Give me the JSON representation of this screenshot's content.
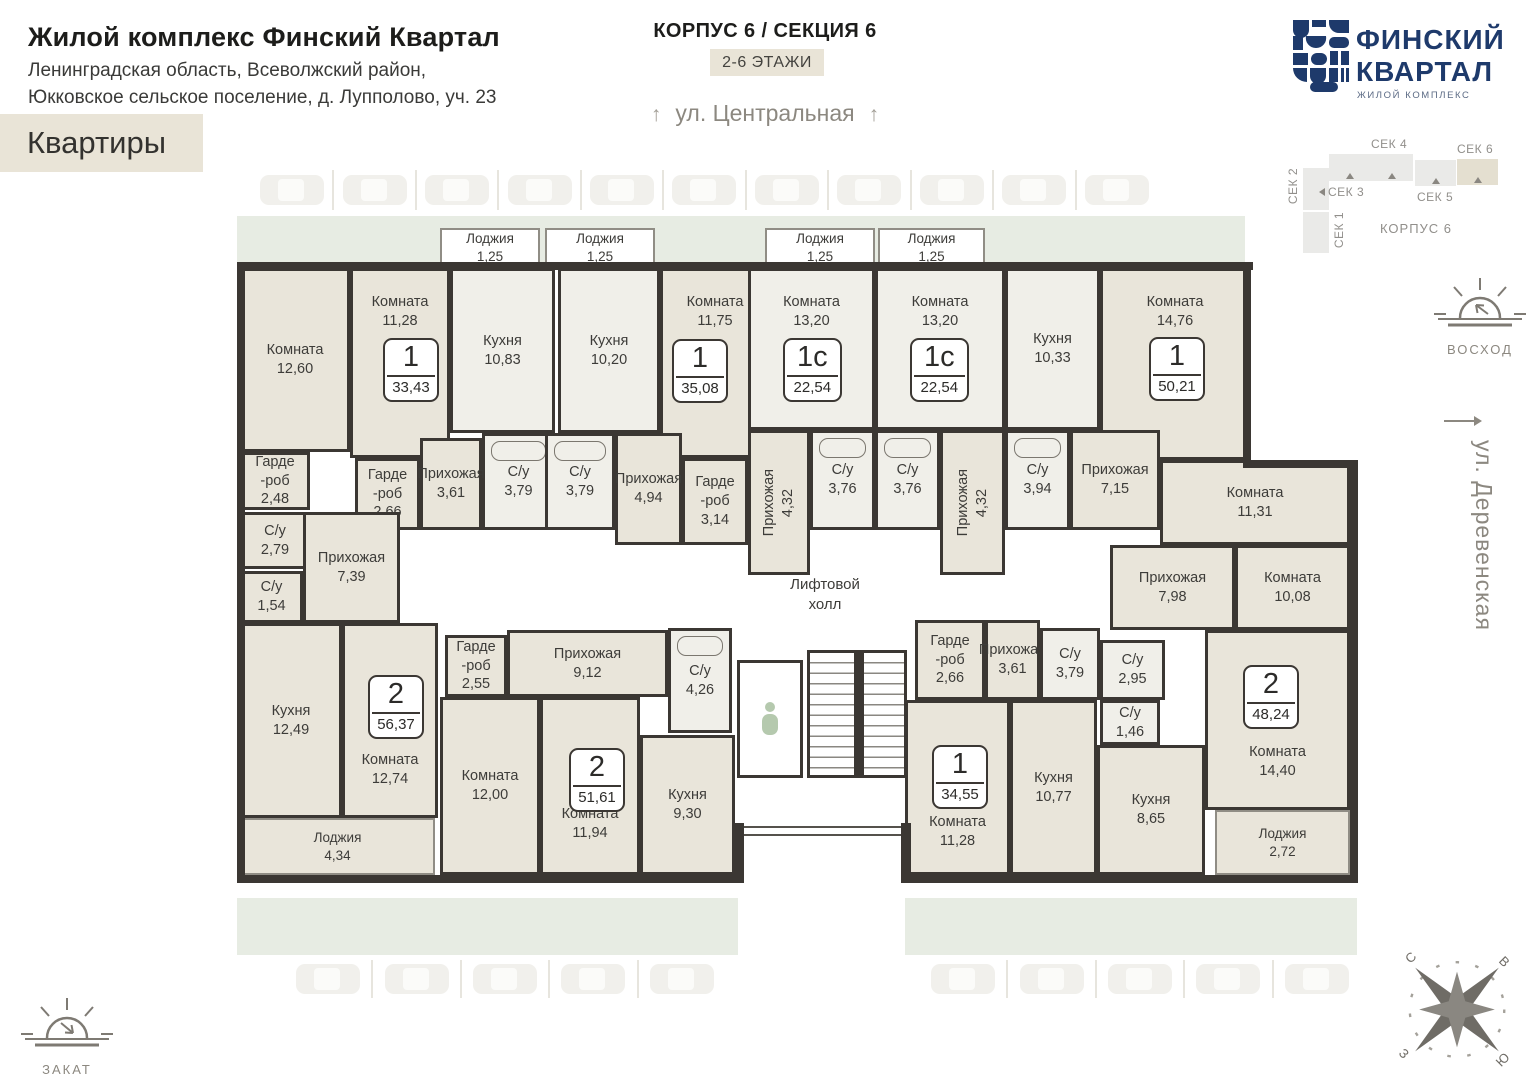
{
  "header": {
    "title": "Жилой комплекс Финский Квартал",
    "address_line1": "Ленинградская область, Всеволжский район,",
    "address_line2": "Юкковское сельское поселение, д. Лупполово, уч. 23",
    "flats_badge": "Квартиры"
  },
  "top_center": {
    "corpus_section": "КОРПУС 6 / СЕКЦИЯ 6",
    "floors_badge": "2-6 ЭТАЖИ",
    "street_top": "ул. Центральная",
    "arrow": "↑"
  },
  "logo": {
    "line1": "ФИНСКИЙ",
    "line2": "КВАРТАЛ",
    "subtitle": "ЖИЛОЙ КОМПЛЕКС",
    "brand_color": "#1e3a6b"
  },
  "minimap": {
    "corpus_label": "КОРПУС 6",
    "blocks": [
      {
        "label": "СЕК 2",
        "x": 18,
        "y": 30,
        "w": 26,
        "h": 42,
        "lpos": "left",
        "marker": "",
        "hl": false
      },
      {
        "label": "СЕК 1",
        "x": 18,
        "y": 74,
        "w": 26,
        "h": 41,
        "lpos": "right",
        "marker": "left",
        "hl": false
      },
      {
        "label": "СЕК 3",
        "x": 44,
        "y": 16,
        "w": 42,
        "h": 27,
        "lpos": "bottom",
        "marker": "up+left",
        "hl": false
      },
      {
        "label": "СЕК 4",
        "x": 86,
        "y": 16,
        "w": 42,
        "h": 27,
        "lpos": "top",
        "marker": "up",
        "hl": false
      },
      {
        "label": "СЕК 5",
        "x": 130,
        "y": 22,
        "w": 41,
        "h": 26,
        "lpos": "bottom",
        "marker": "up",
        "hl": false
      },
      {
        "label": "СЕК 6",
        "x": 172,
        "y": 21,
        "w": 41,
        "h": 26,
        "lpos": "top",
        "marker": "up",
        "hl": true
      }
    ]
  },
  "streets": {
    "right": "ул. Деревенская"
  },
  "sun": {
    "sunrise": "ВОСХОД",
    "sunset": "ЗАКАТ"
  },
  "compass": {
    "n": "С",
    "e": "В",
    "w": "З",
    "s": "Ю"
  },
  "colors": {
    "wall": "#3b3733",
    "cream": "#e9e5da",
    "light": "#f0efe9",
    "green_strip": "#e7ece3",
    "badge_beige": "#e9e4d7",
    "brand_navy": "#1e3a6b"
  },
  "parking": {
    "top_count": 11,
    "bottom_left_count": 5,
    "bottom_right_count": 5
  },
  "plan": {
    "lift_hall": "Лифтовой\nхолл",
    "rooms": [
      {
        "n": "Комната",
        "a": "12,60",
        "x": 3,
        "y": 43,
        "w": 110,
        "h": 184,
        "f": "c"
      },
      {
        "n": "Комната",
        "a": "11,28",
        "x": 113,
        "y": 43,
        "w": 100,
        "h": 190,
        "f": "c",
        "lp": "t"
      },
      {
        "n": "Кухня",
        "a": "10,83",
        "x": 213,
        "y": 43,
        "w": 105,
        "h": 165,
        "f": "l"
      },
      {
        "n": "С/у",
        "a": "3,79",
        "x": 245,
        "y": 208,
        "w": 73,
        "h": 97,
        "f": "l",
        "bath": 1
      },
      {
        "n": "Гарде\n-роб",
        "a": "2,66",
        "x": 118,
        "y": 233,
        "w": 65,
        "h": 72,
        "f": "c"
      },
      {
        "n": "Прихожая",
        "a": "3,61",
        "x": 183,
        "y": 213,
        "w": 62,
        "h": 92,
        "f": "c"
      },
      {
        "n": "Гарде\n-роб",
        "a": "2,48",
        "x": 3,
        "y": 227,
        "w": 70,
        "h": 58,
        "f": "c"
      },
      {
        "n": "С/у",
        "a": "2,79",
        "x": 3,
        "y": 287,
        "w": 70,
        "h": 57,
        "f": "c"
      },
      {
        "n": "С/у",
        "a": "1,54",
        "x": 3,
        "y": 346,
        "w": 63,
        "h": 52,
        "f": "c"
      },
      {
        "n": "Прихожая",
        "a": "7,39",
        "x": 66,
        "y": 287,
        "w": 97,
        "h": 111,
        "f": "c"
      },
      {
        "n": "Кухня",
        "a": "10,20",
        "x": 321,
        "y": 43,
        "w": 102,
        "h": 165,
        "f": "l"
      },
      {
        "n": "Комната",
        "a": "11,75",
        "x": 423,
        "y": 43,
        "w": 110,
        "h": 190,
        "f": "c",
        "lp": "t"
      },
      {
        "n": "С/у",
        "a": "3,79",
        "x": 308,
        "y": 208,
        "w": 70,
        "h": 97,
        "f": "l",
        "bath": 1
      },
      {
        "n": "Прихожая",
        "a": "4,94",
        "x": 378,
        "y": 208,
        "w": 67,
        "h": 112,
        "f": "c"
      },
      {
        "n": "Гарде\n-роб",
        "a": "3,14",
        "x": 445,
        "y": 233,
        "w": 66,
        "h": 87,
        "f": "c"
      },
      {
        "n": "Комната",
        "a": "13,20",
        "x": 511,
        "y": 43,
        "w": 127,
        "h": 162,
        "f": "l",
        "lp": "t"
      },
      {
        "n": "Прихожая",
        "a": "4,32",
        "x": 511,
        "y": 205,
        "w": 62,
        "h": 145,
        "f": "c",
        "v": 1
      },
      {
        "n": "С/у",
        "a": "3,76",
        "x": 573,
        "y": 205,
        "w": 65,
        "h": 100,
        "f": "l",
        "bath": 1
      },
      {
        "n": "Комната",
        "a": "13,20",
        "x": 638,
        "y": 43,
        "w": 130,
        "h": 162,
        "f": "l",
        "lp": "t"
      },
      {
        "n": "С/у",
        "a": "3,76",
        "x": 638,
        "y": 205,
        "w": 65,
        "h": 100,
        "f": "l",
        "bath": 1
      },
      {
        "n": "Прихожая",
        "a": "4,32",
        "x": 703,
        "y": 205,
        "w": 65,
        "h": 145,
        "f": "c",
        "v": 1
      },
      {
        "n": "Кухня",
        "a": "10,33",
        "x": 768,
        "y": 43,
        "w": 95,
        "h": 162,
        "f": "l"
      },
      {
        "n": "Комната",
        "a": "14,76",
        "x": 863,
        "y": 43,
        "w": 150,
        "h": 192,
        "f": "c",
        "lp": "t"
      },
      {
        "n": "С/у",
        "a": "3,94",
        "x": 768,
        "y": 205,
        "w": 65,
        "h": 100,
        "f": "l",
        "bath": 1
      },
      {
        "n": "Прихожая",
        "a": "7,15",
        "x": 833,
        "y": 205,
        "w": 90,
        "h": 100,
        "f": "c"
      },
      {
        "n": "Комната",
        "a": "11,31",
        "x": 923,
        "y": 235,
        "w": 190,
        "h": 85,
        "f": "c"
      },
      {
        "n": "Прихожая",
        "a": "7,98",
        "x": 873,
        "y": 320,
        "w": 125,
        "h": 85,
        "f": "c"
      },
      {
        "n": "Комната",
        "a": "10,08",
        "x": 998,
        "y": 320,
        "w": 115,
        "h": 85,
        "f": "c"
      },
      {
        "n": "С/у",
        "a": "2,95",
        "x": 863,
        "y": 415,
        "w": 65,
        "h": 60,
        "f": "l"
      },
      {
        "n": "С/у",
        "a": "1,46",
        "x": 863,
        "y": 475,
        "w": 60,
        "h": 45,
        "f": "l"
      },
      {
        "n": "Кухня",
        "a": "8,65",
        "x": 860,
        "y": 520,
        "w": 108,
        "h": 130,
        "f": "c"
      },
      {
        "n": "Комната",
        "a": "14,40",
        "x": 968,
        "y": 405,
        "w": 145,
        "h": 180,
        "f": "c",
        "ly": 110
      },
      {
        "n": "Гарде\n-роб",
        "a": "2,55",
        "x": 208,
        "y": 410,
        "w": 62,
        "h": 62,
        "f": "c"
      },
      {
        "n": "Прихожая",
        "a": "9,12",
        "x": 270,
        "y": 405,
        "w": 161,
        "h": 67,
        "f": "c"
      },
      {
        "n": "С/у",
        "a": "4,26",
        "x": 431,
        "y": 403,
        "w": 64,
        "h": 105,
        "f": "l",
        "bath": 1
      },
      {
        "n": "Комната",
        "a": "12,00",
        "x": 203,
        "y": 472,
        "w": 100,
        "h": 178,
        "f": "c"
      },
      {
        "n": "Комната",
        "a": "11,94",
        "x": 303,
        "y": 472,
        "w": 100,
        "h": 178,
        "f": "c",
        "ly": 105
      },
      {
        "n": "Кухня",
        "a": "9,30",
        "x": 403,
        "y": 510,
        "w": 95,
        "h": 140,
        "f": "c"
      },
      {
        "n": "Гарде\n-роб",
        "a": "2,66",
        "x": 678,
        "y": 395,
        "w": 70,
        "h": 80,
        "f": "c"
      },
      {
        "n": "Комната",
        "a": "11,28",
        "x": 668,
        "y": 475,
        "w": 105,
        "h": 175,
        "f": "c",
        "ly": 110
      },
      {
        "n": "Прихожая",
        "a": "3,61",
        "x": 748,
        "y": 395,
        "w": 55,
        "h": 80,
        "f": "c"
      },
      {
        "n": "С/у",
        "a": "3,79",
        "x": 803,
        "y": 403,
        "w": 60,
        "h": 72,
        "f": "l"
      },
      {
        "n": "Кухня",
        "a": "10,77",
        "x": 773,
        "y": 475,
        "w": 87,
        "h": 175,
        "f": "c"
      },
      {
        "n": "Кухня",
        "a": "12,49",
        "x": 3,
        "y": 398,
        "w": 102,
        "h": 195,
        "f": "c"
      },
      {
        "n": "Комната",
        "a": "12,74",
        "x": 105,
        "y": 398,
        "w": 96,
        "h": 195,
        "f": "c",
        "ly": 125
      },
      {
        "n": "Лоджия",
        "a": "1,25",
        "x": 203,
        "y": 3,
        "w": 100,
        "h": 40,
        "f": "w",
        "thin": 1
      },
      {
        "n": "Лоджия",
        "a": "1,25",
        "x": 308,
        "y": 3,
        "w": 110,
        "h": 40,
        "f": "w",
        "thin": 1
      },
      {
        "n": "Лоджия",
        "a": "1,25",
        "x": 528,
        "y": 3,
        "w": 110,
        "h": 40,
        "f": "w",
        "thin": 1
      },
      {
        "n": "Лоджия",
        "a": "1,25",
        "x": 641,
        "y": 3,
        "w": 107,
        "h": 40,
        "f": "w",
        "thin": 1
      },
      {
        "n": "Лоджия",
        "a": "4,34",
        "x": 3,
        "y": 593,
        "w": 195,
        "h": 57,
        "f": "c",
        "thin": 1
      },
      {
        "n": "Лоджия",
        "a": "2,72",
        "x": 978,
        "y": 585,
        "w": 135,
        "h": 65,
        "f": "c",
        "thin": 1
      }
    ],
    "badges": [
      {
        "t": "1",
        "a": "33,43",
        "x": 146,
        "y": 113
      },
      {
        "t": "1",
        "a": "35,08",
        "x": 435,
        "y": 114
      },
      {
        "t": "1с",
        "a": "22,54",
        "x": 546,
        "y": 113
      },
      {
        "t": "1с",
        "a": "22,54",
        "x": 673,
        "y": 113
      },
      {
        "t": "1",
        "a": "50,21",
        "x": 912,
        "y": 112
      },
      {
        "t": "2",
        "a": "48,24",
        "x": 1006,
        "y": 440
      },
      {
        "t": "1",
        "a": "34,55",
        "x": 695,
        "y": 520
      },
      {
        "t": "2",
        "a": "51,61",
        "x": 332,
        "y": 523
      },
      {
        "t": "2",
        "a": "56,37",
        "x": 131,
        "y": 450
      }
    ],
    "walls": [
      {
        "x": 0,
        "y": 37,
        "w": 1016,
        "h": 8
      },
      {
        "x": 0,
        "y": 37,
        "w": 8,
        "h": 621
      },
      {
        "x": 0,
        "y": 650,
        "w": 505,
        "h": 8
      },
      {
        "x": 670,
        "y": 650,
        "w": 451,
        "h": 8
      },
      {
        "x": 1006,
        "y": 37,
        "w": 8,
        "h": 206
      },
      {
        "x": 1006,
        "y": 235,
        "w": 115,
        "h": 8
      },
      {
        "x": 1113,
        "y": 235,
        "w": 8,
        "h": 423
      },
      {
        "x": 497,
        "y": 598,
        "w": 10,
        "h": 60
      },
      {
        "x": 664,
        "y": 598,
        "w": 10,
        "h": 60
      }
    ]
  }
}
